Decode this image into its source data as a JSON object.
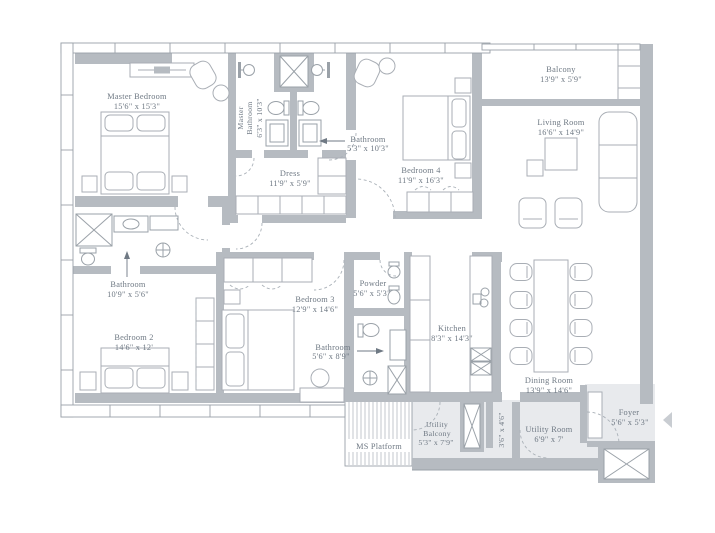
{
  "plan_title": "Floor Plan",
  "colors": {
    "wall": "#b6bbc1",
    "outline": "#9aa1a8",
    "furniture": "#a9aeb5",
    "text": "#6f7984",
    "floor_shade": "#e8eaed"
  },
  "rooms": {
    "master_bedroom": {
      "name": "Master Bedroom",
      "dims": "15'6\" x 15'3\""
    },
    "master_bathroom": {
      "name_line1": "Master",
      "name_line2": "Bathroom",
      "dims": "6'3\" x 10'3\""
    },
    "bathroom_top": {
      "name": "Bathroom",
      "dims": "5'3\" x 10'3\""
    },
    "dress": {
      "name": "Dress",
      "dims": "11'9\" x 5'9\""
    },
    "bedroom_4": {
      "name": "Bedroom 4",
      "dims": "11'9\" x 16'3\""
    },
    "balcony": {
      "name": "Balcony",
      "dims": "13'9\" x 5'9\""
    },
    "living_room": {
      "name": "Living Room",
      "dims": "16'6\" x 14'9\""
    },
    "bathroom_left": {
      "name": "Bathroom",
      "dims": "10'9\" x 5'6\""
    },
    "bedroom_2": {
      "name": "Bedroom 2",
      "dims": "14'6\" x 12'"
    },
    "bedroom_3": {
      "name": "Bedroom 3",
      "dims": "12'9\" x 14'6\""
    },
    "powder": {
      "name": "Powder",
      "dims": "5'6\" x 5'3\""
    },
    "bathroom_mid": {
      "name": "Bathroom",
      "dims": "5'6\" x 8'9\""
    },
    "kitchen": {
      "name": "Kitchen",
      "dims": "8'3\" x 14'3\""
    },
    "dining_room": {
      "name": "Dining Room",
      "dims": "13'9\" x 14'6\""
    },
    "ms_platform": {
      "name": "MS Platform"
    },
    "utility_balcony": {
      "name_line1": "Utility",
      "name_line2": "Balcony",
      "dims": "5'3\" x 7'9\""
    },
    "passage": {
      "dims": "3'6\" x 4'6\""
    },
    "utility_room": {
      "name": "Utility Room",
      "dims": "6'9\" x 7'"
    },
    "foyer": {
      "name": "Foyer",
      "dims": "5'6\" x 5'3\""
    }
  }
}
